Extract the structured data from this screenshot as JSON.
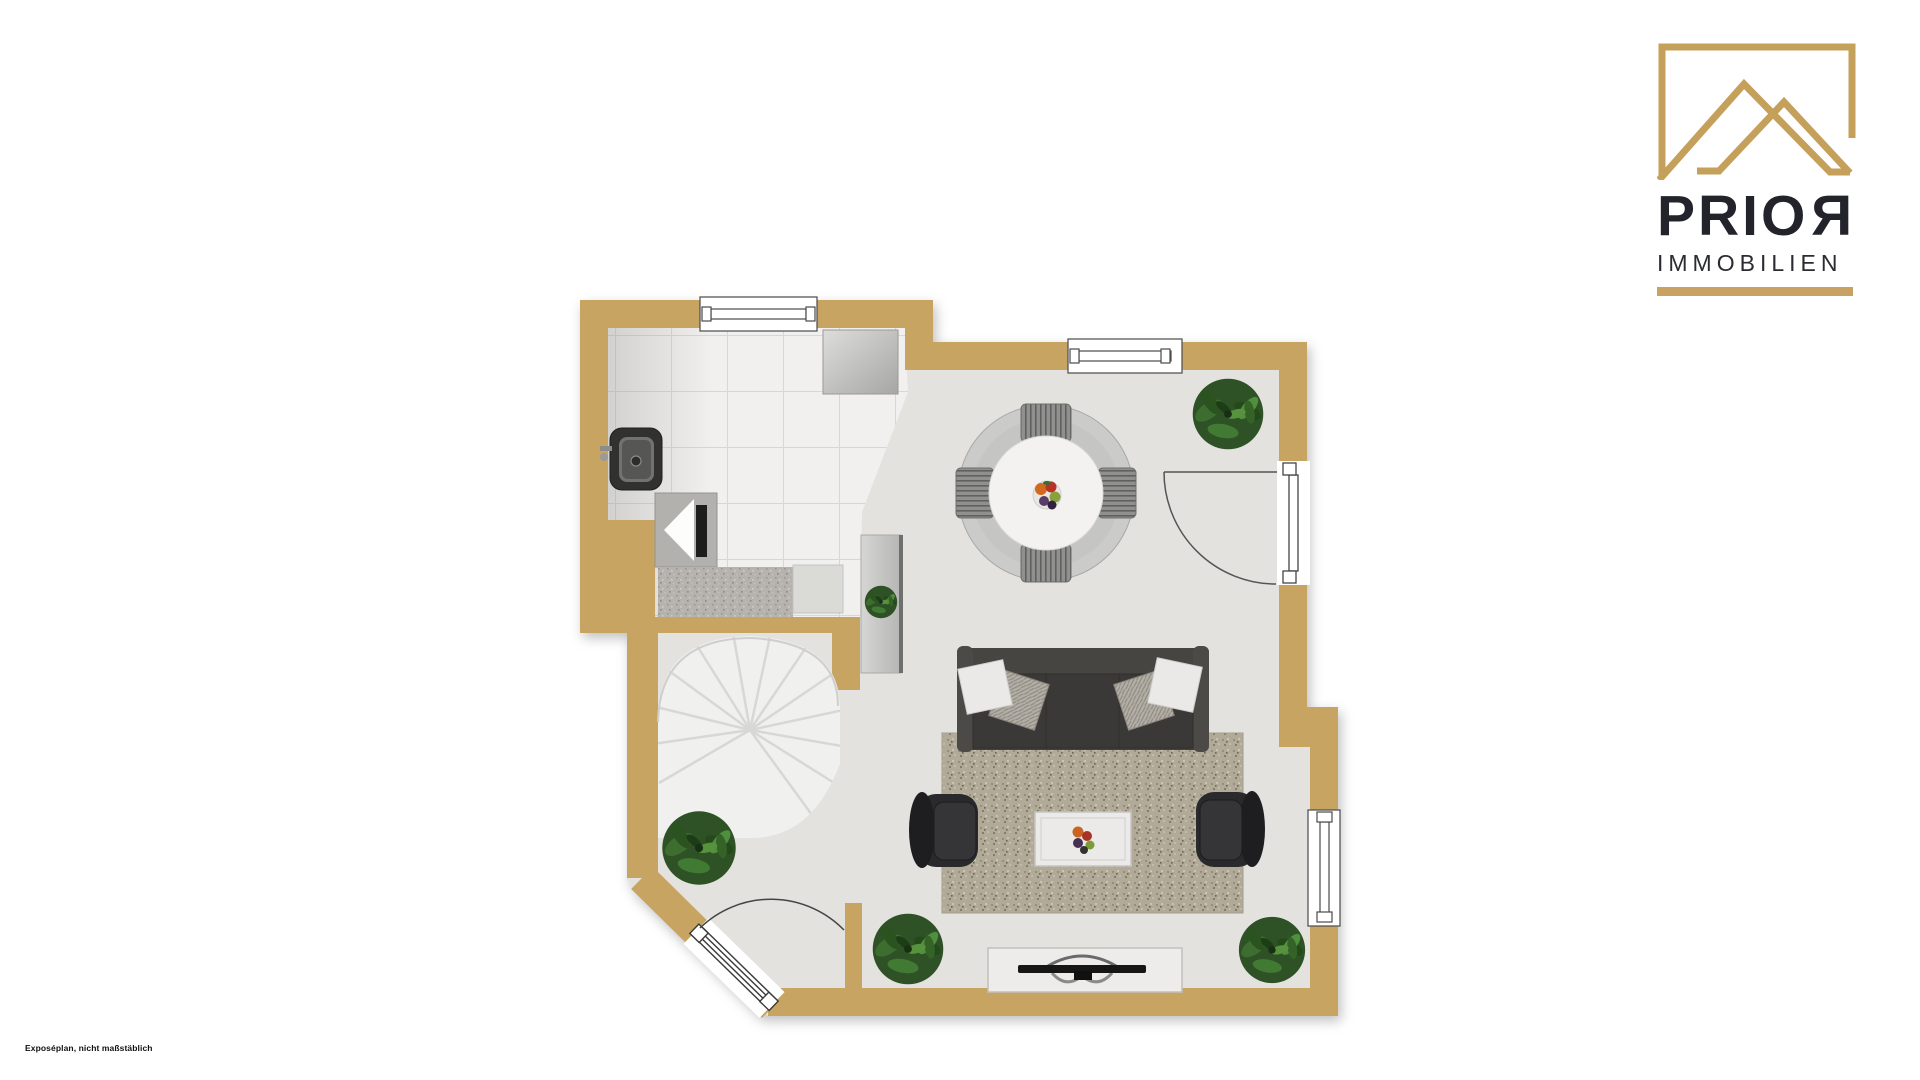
{
  "page": {
    "caption": "Exposéplan, nicht maßstäblich"
  },
  "logo": {
    "brand_main": "PRIO",
    "brand_mirrored_letter": "R",
    "subtitle": "IMMOBILIEN"
  },
  "colors": {
    "gold": "#c7a262",
    "wall": "#c8a463",
    "floor": "#e3e2df",
    "tile": "#f1f0ef",
    "logo-text": "#23242b",
    "caption-text": "#101010",
    "outside": "#ffffff"
  },
  "floorplan": {
    "type": "apartment-floor-plan",
    "furniture": [
      "round-dining-table",
      "dining-chairs",
      "fruit-bowl",
      "sofa",
      "sofa-cushions",
      "area-rug",
      "coffee-table",
      "armchair-left",
      "armchair-right",
      "tv-sideboard",
      "television",
      "spiral-staircase",
      "kitchen-sink",
      "stove",
      "kitchen-counter",
      "kitchen-cabinet",
      "console-table",
      "potted-plant",
      "entrance-door",
      "balcony-door",
      "window"
    ]
  }
}
